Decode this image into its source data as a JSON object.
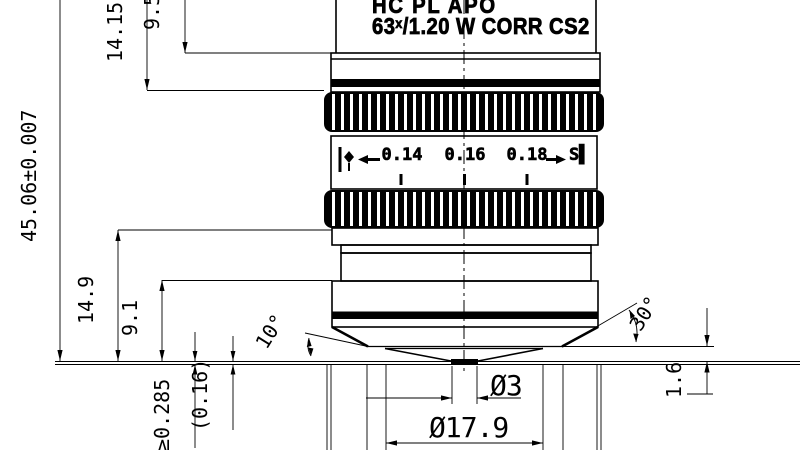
{
  "objective": {
    "engraving_line1": "HC PL APO",
    "engraving_magnification": "63",
    "engraving_x": "x",
    "engraving_line2": "/1.20 W CORR CS2",
    "correction_scale": {
      "left_icon": "|◆",
      "left_arrow": "←",
      "values": [
        "0.14",
        "0.16",
        "0.18"
      ],
      "right_arrow": "→",
      "right_icon": "S▌"
    }
  },
  "dimensions": {
    "parfocal_length": "45.06±0.007",
    "top_to_knurl": "14.15",
    "top_to_step": "9.5",
    "knurl_to_focal_plane": "14.9",
    "nose_to_focal_plane": "9.1",
    "working_distance": "≥0.285",
    "cover_glass_thickness": "(0.16)",
    "front_cone_angle": "10°",
    "nose_cone_angle": "30°",
    "tip_clearance": "1.6",
    "front_lens_diameter": "Ø3",
    "nose_diameter": "Ø17.9"
  }
}
